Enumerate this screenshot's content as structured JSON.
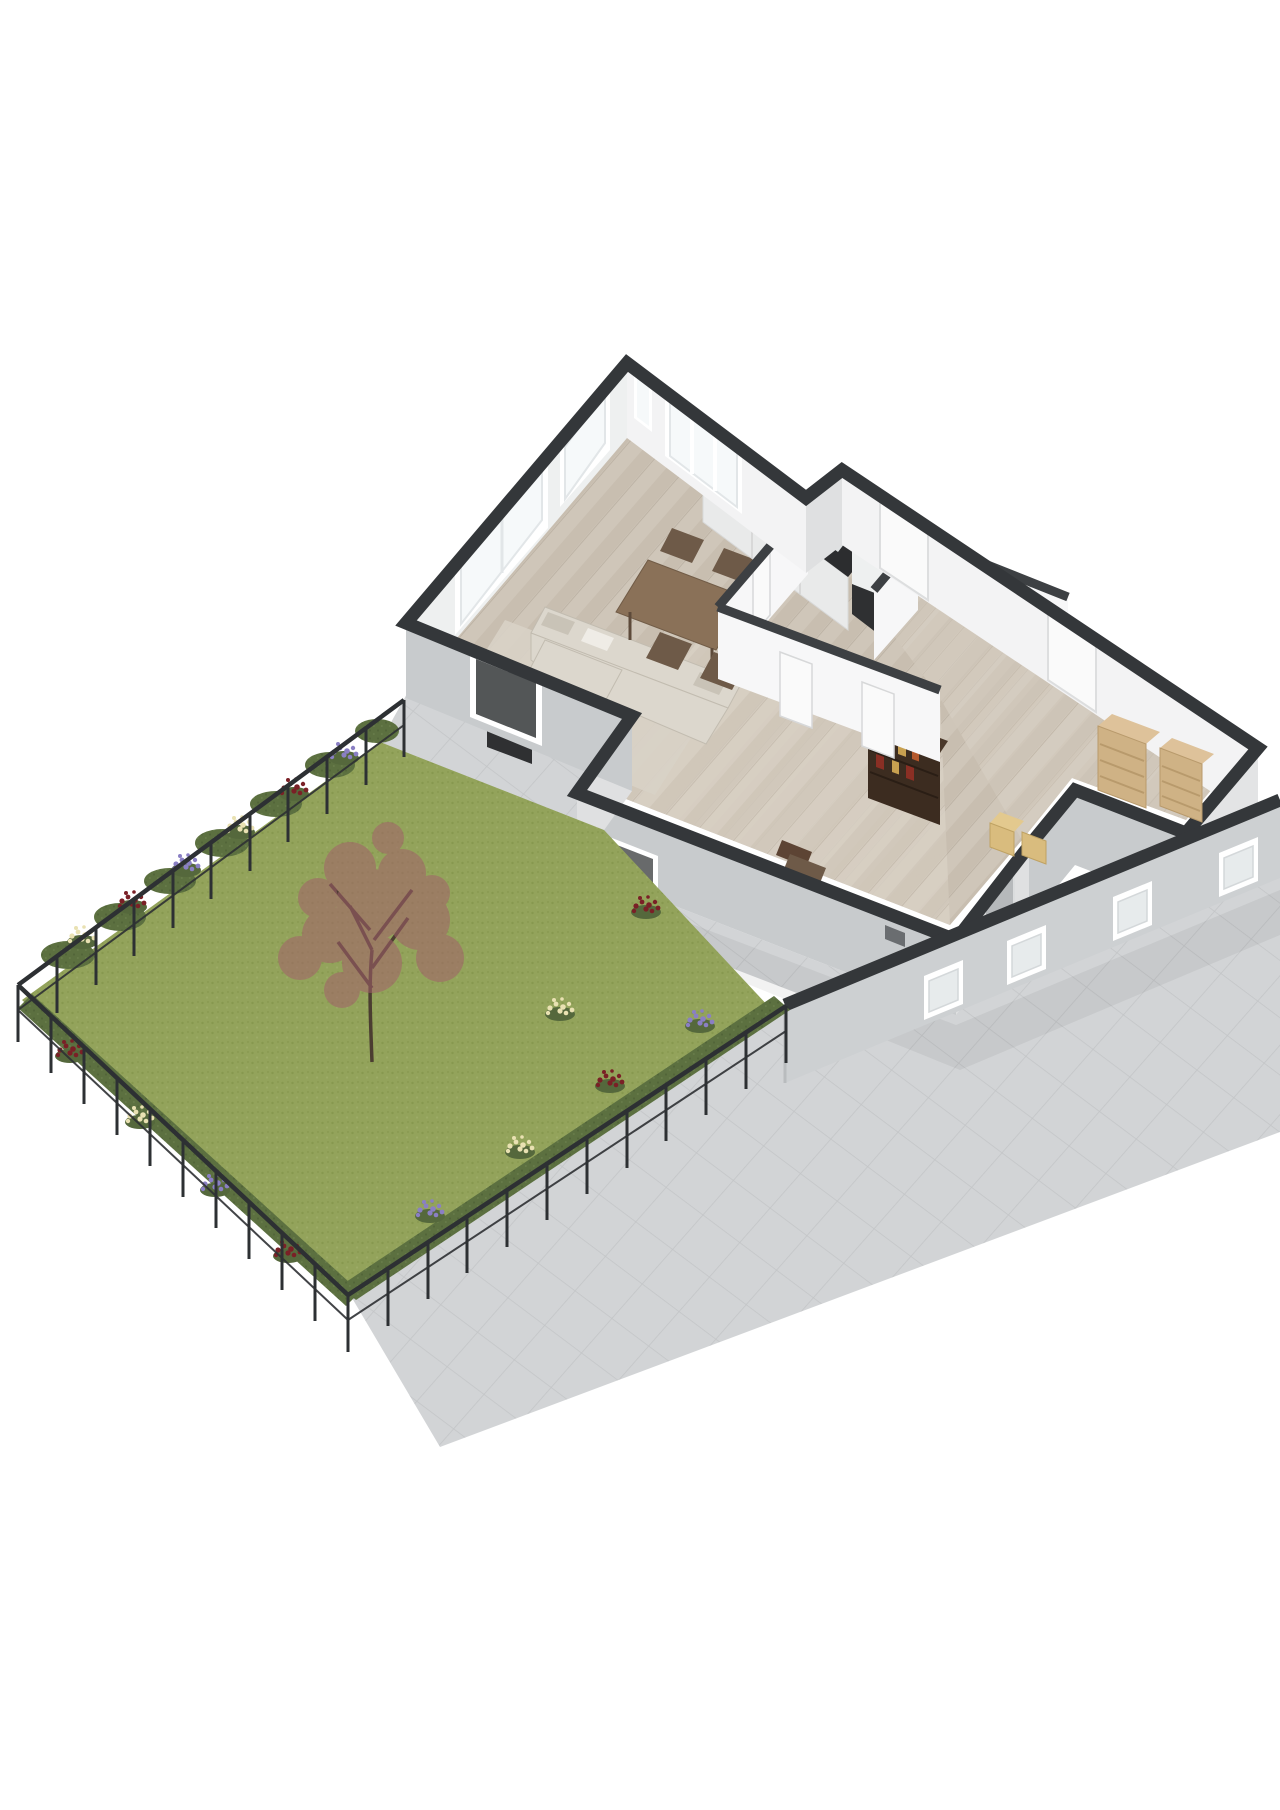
{
  "scene": {
    "type": "3d-floorplan-isometric-render",
    "background": "#ffffff",
    "description-elements": [
      "house-ground-floor",
      "garden",
      "paved-walkway",
      "storage-wing"
    ]
  },
  "palette": {
    "background": "#ffffff",
    "wall_cap": "#34373a",
    "partition_cap": "#3d4043",
    "wall_interior": "#eef0f0",
    "wall_interior_bright": "#f3f3f4",
    "partition_face": "#f7f7f8",
    "wall_exterior_shade": "#c8cbcd",
    "wall_exterior_light": "#dfe0e1",
    "wall_exterior_se": "#e3e4e5",
    "band_face": "#cdd0d2",
    "floor_wood": "#cfc6b9",
    "floor_wood_light": "#d8d0c4",
    "paving": "#d2d4d6",
    "paving_line": "#c3c5c7",
    "courtyard": "#d0d2d4",
    "shadow": "#000000",
    "lawn": "#93a35b",
    "lawn_dot_dark": "#87984f",
    "lawn_dot_light": "#9cab66",
    "hedge": "#5c7040",
    "hedge_dot": "#526539",
    "fence": "#2d3033",
    "tree_trunk": "#4b3d31",
    "tree_foliage": "#a2606a",
    "flower_red": "#7a2026",
    "flower_cream": "#e9e1b2",
    "flower_purple": "#8a7fc4",
    "leaf_green": "#4f6339",
    "rug": "#d8d1c6",
    "sofa": "#dcd7cd",
    "sofa_shade": "#c9c3b7",
    "coffee_table": "#5f4b39",
    "dining_table": "#8a7158",
    "chair_wood": "#6e5a48",
    "counter_dark": "#2c2d2f",
    "cabinet_white": "#e9eaea",
    "stove_steel": "#aeb2b5",
    "sink_steel": "#dfe2e3",
    "unit_black": "#2f3032",
    "bookcase_dark": "#3c2c20",
    "book_orange": "#b4582c",
    "book_red": "#8a2f24",
    "book_tan": "#c8a050",
    "shelf_tan": "#cfb285",
    "box_tan": "#d9bc7e",
    "door_gray": "#b6b9bb",
    "door_white": "#fafafa",
    "glass_dark": "#35383a",
    "window_frame": "#ffffff",
    "toilet_white": "#fdfdfd",
    "bed_linen": "#e9e7e3",
    "stairs": "#f4f4f4"
  },
  "inventory": {
    "rooms": [
      "living-room",
      "dining-area",
      "kitchen",
      "hallway",
      "bathroom",
      "study",
      "storage-room",
      "courtyard"
    ],
    "furniture": [
      "corner-sofa",
      "rug",
      "coffee-table",
      "tv",
      "dining-table",
      "dining-chairs",
      "kitchen-counter",
      "stove",
      "sink",
      "toilet",
      "bookcase",
      "desk-chair",
      "bed",
      "stairs",
      "storage-shelves",
      "boxes"
    ],
    "garden": [
      "lawn",
      "red-leaf-tree",
      "hedges",
      "flower-borders",
      "metal-fence",
      "paved-walkway"
    ]
  }
}
